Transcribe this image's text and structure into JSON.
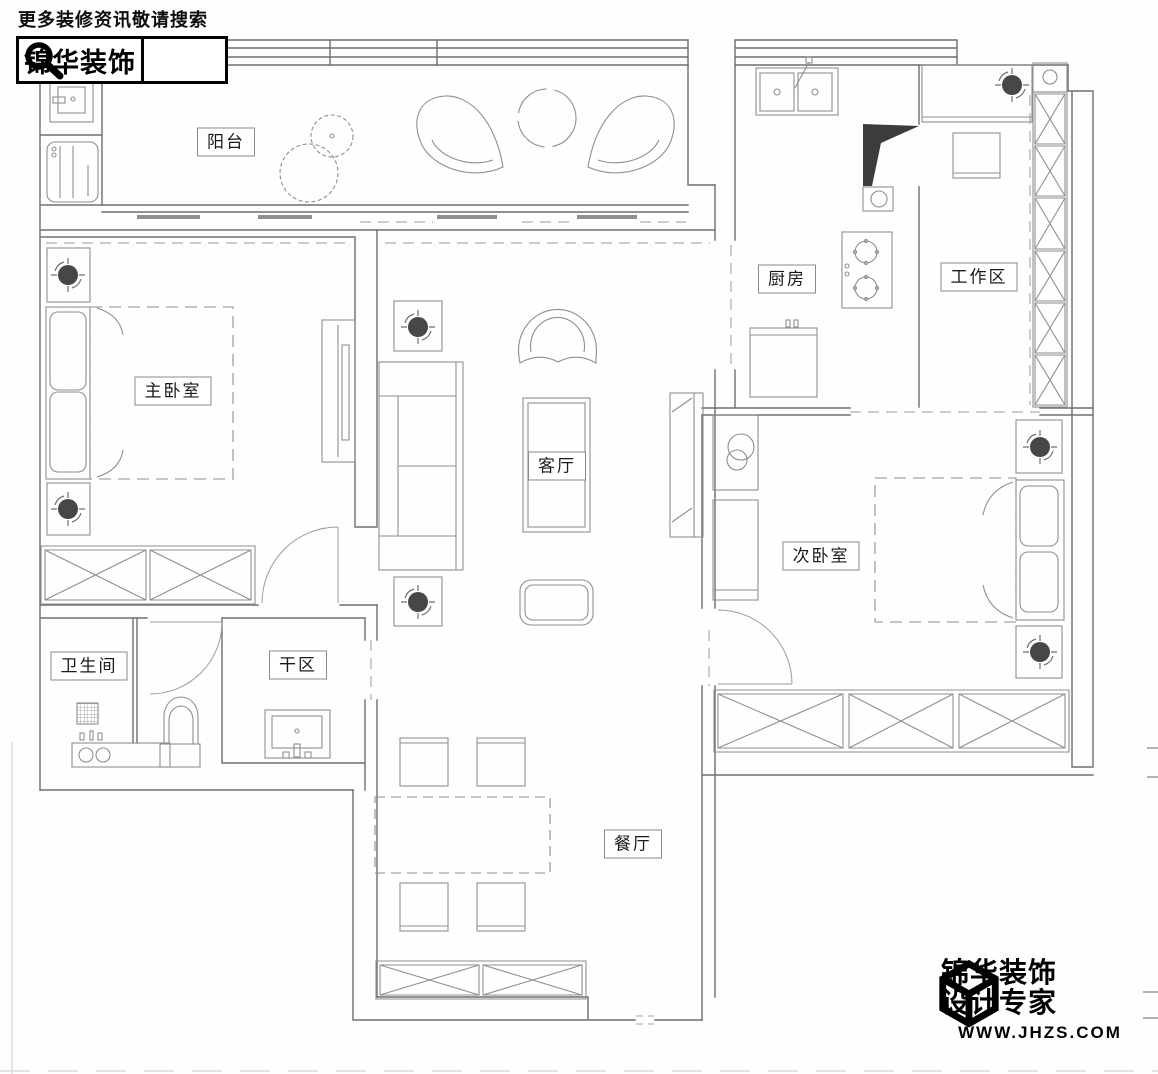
{
  "header": {
    "promo": "更多装修资讯敬请搜索",
    "brand": "锦华装饰",
    "search_icon": "magnifier-icon"
  },
  "rooms": [
    {
      "id": "yangtai",
      "name": "阳台",
      "x": 226,
      "y": 142
    },
    {
      "id": "zhuwoshi",
      "name": "主卧室",
      "x": 173,
      "y": 391
    },
    {
      "id": "chufang",
      "name": "厨房",
      "x": 787,
      "y": 279
    },
    {
      "id": "gongzuoqu",
      "name": "工作区",
      "x": 979,
      "y": 277
    },
    {
      "id": "keting",
      "name": "客厅",
      "x": 557,
      "y": 466
    },
    {
      "id": "ciwoshi",
      "name": "次卧室",
      "x": 821,
      "y": 556
    },
    {
      "id": "weishengjian",
      "name": "卫生间",
      "x": 89,
      "y": 666
    },
    {
      "id": "ganqu",
      "name": "干区",
      "x": 298,
      "y": 665
    },
    {
      "id": "canting",
      "name": "餐厅",
      "x": 633,
      "y": 844
    }
  ],
  "footer": {
    "line1": "锦华装饰",
    "line2": "设计专家",
    "url": "WWW.JHZS.COM",
    "cube_icon": "cube-logo-icon"
  },
  "colors": {
    "wall_line": "#6e6e6e",
    "furniture_line": "#8f8f8f",
    "accent_dark": "#3c3c3c",
    "brand_black": "#000000"
  }
}
